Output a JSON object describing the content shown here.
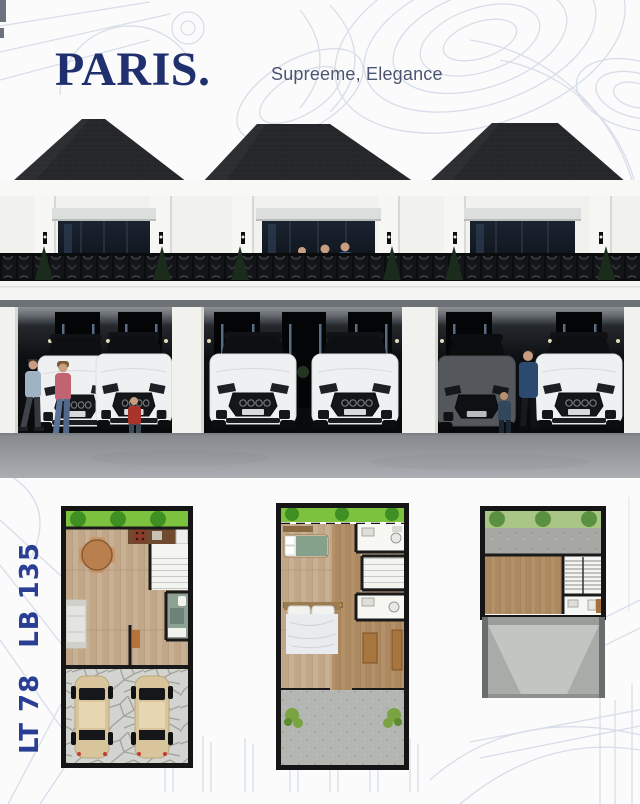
{
  "header": {
    "title": "PARIS.",
    "subtitle": "Supreeme, Elegance"
  },
  "specs": {
    "land_area_label": "LT 78",
    "building_area_label": "LB 135"
  },
  "colors": {
    "brand_navy": "#20306e",
    "subtitle_blue_gray": "#4b5571",
    "spec_label_blue": "#2a3f93",
    "roof_charcoal": "#26282b",
    "background_line_art": "#ccd3e3",
    "road_gray": "#95989c",
    "plan_lawn_green": "#7cc23f",
    "plan_wood_tan": "#c8b094",
    "plan_concrete_gray": "#b4b6b2"
  }
}
